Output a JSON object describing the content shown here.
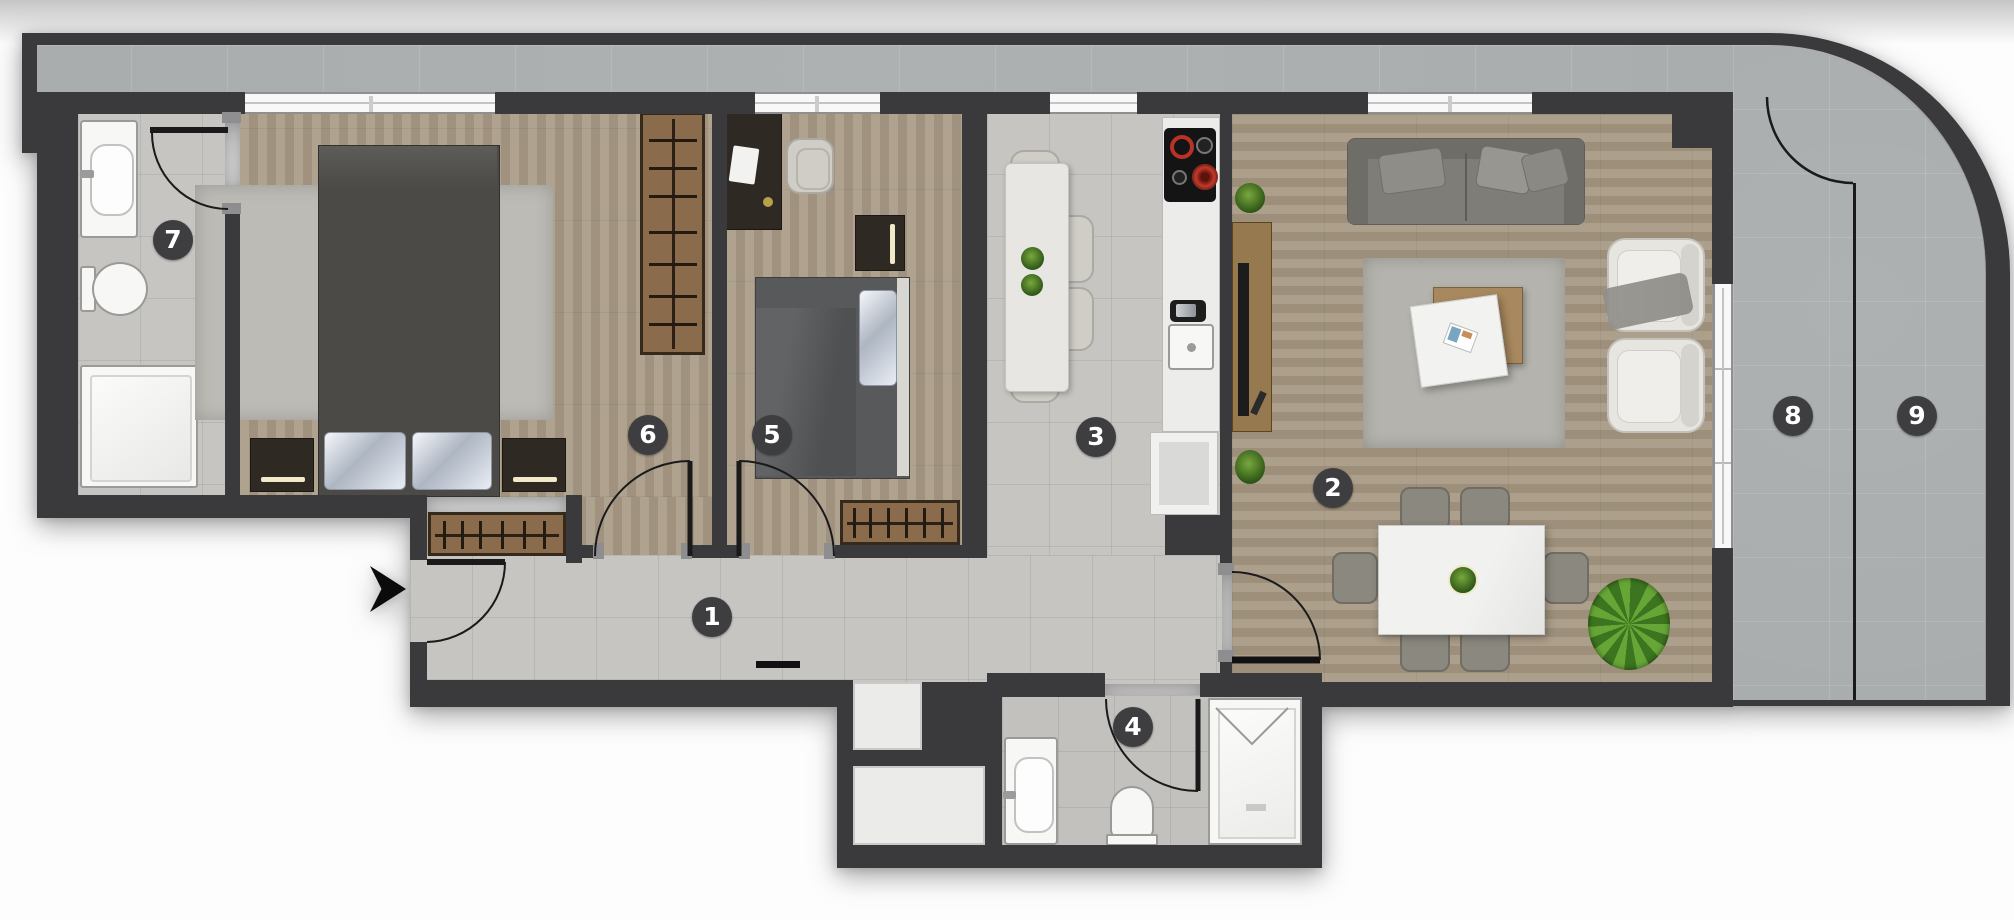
{
  "plan_title": "apartment-floor-plan",
  "rooms": [
    {
      "number": "1"
    },
    {
      "number": "2"
    },
    {
      "number": "3"
    },
    {
      "number": "4"
    },
    {
      "number": "5"
    },
    {
      "number": "6"
    },
    {
      "number": "7"
    },
    {
      "number": "8"
    },
    {
      "number": "9"
    }
  ],
  "colors": {
    "wall": "#3a3a3c",
    "tile_floor": "#c6c5c2",
    "wood_floor": "#a89a86",
    "terrace_tile": "#a9adad",
    "badge": "#3e3e40",
    "fixture_white": "#f7f7f5",
    "furniture_wood": "#8a6c4d",
    "plant_green": "#4e8526",
    "stove_red": "#c0392b"
  }
}
